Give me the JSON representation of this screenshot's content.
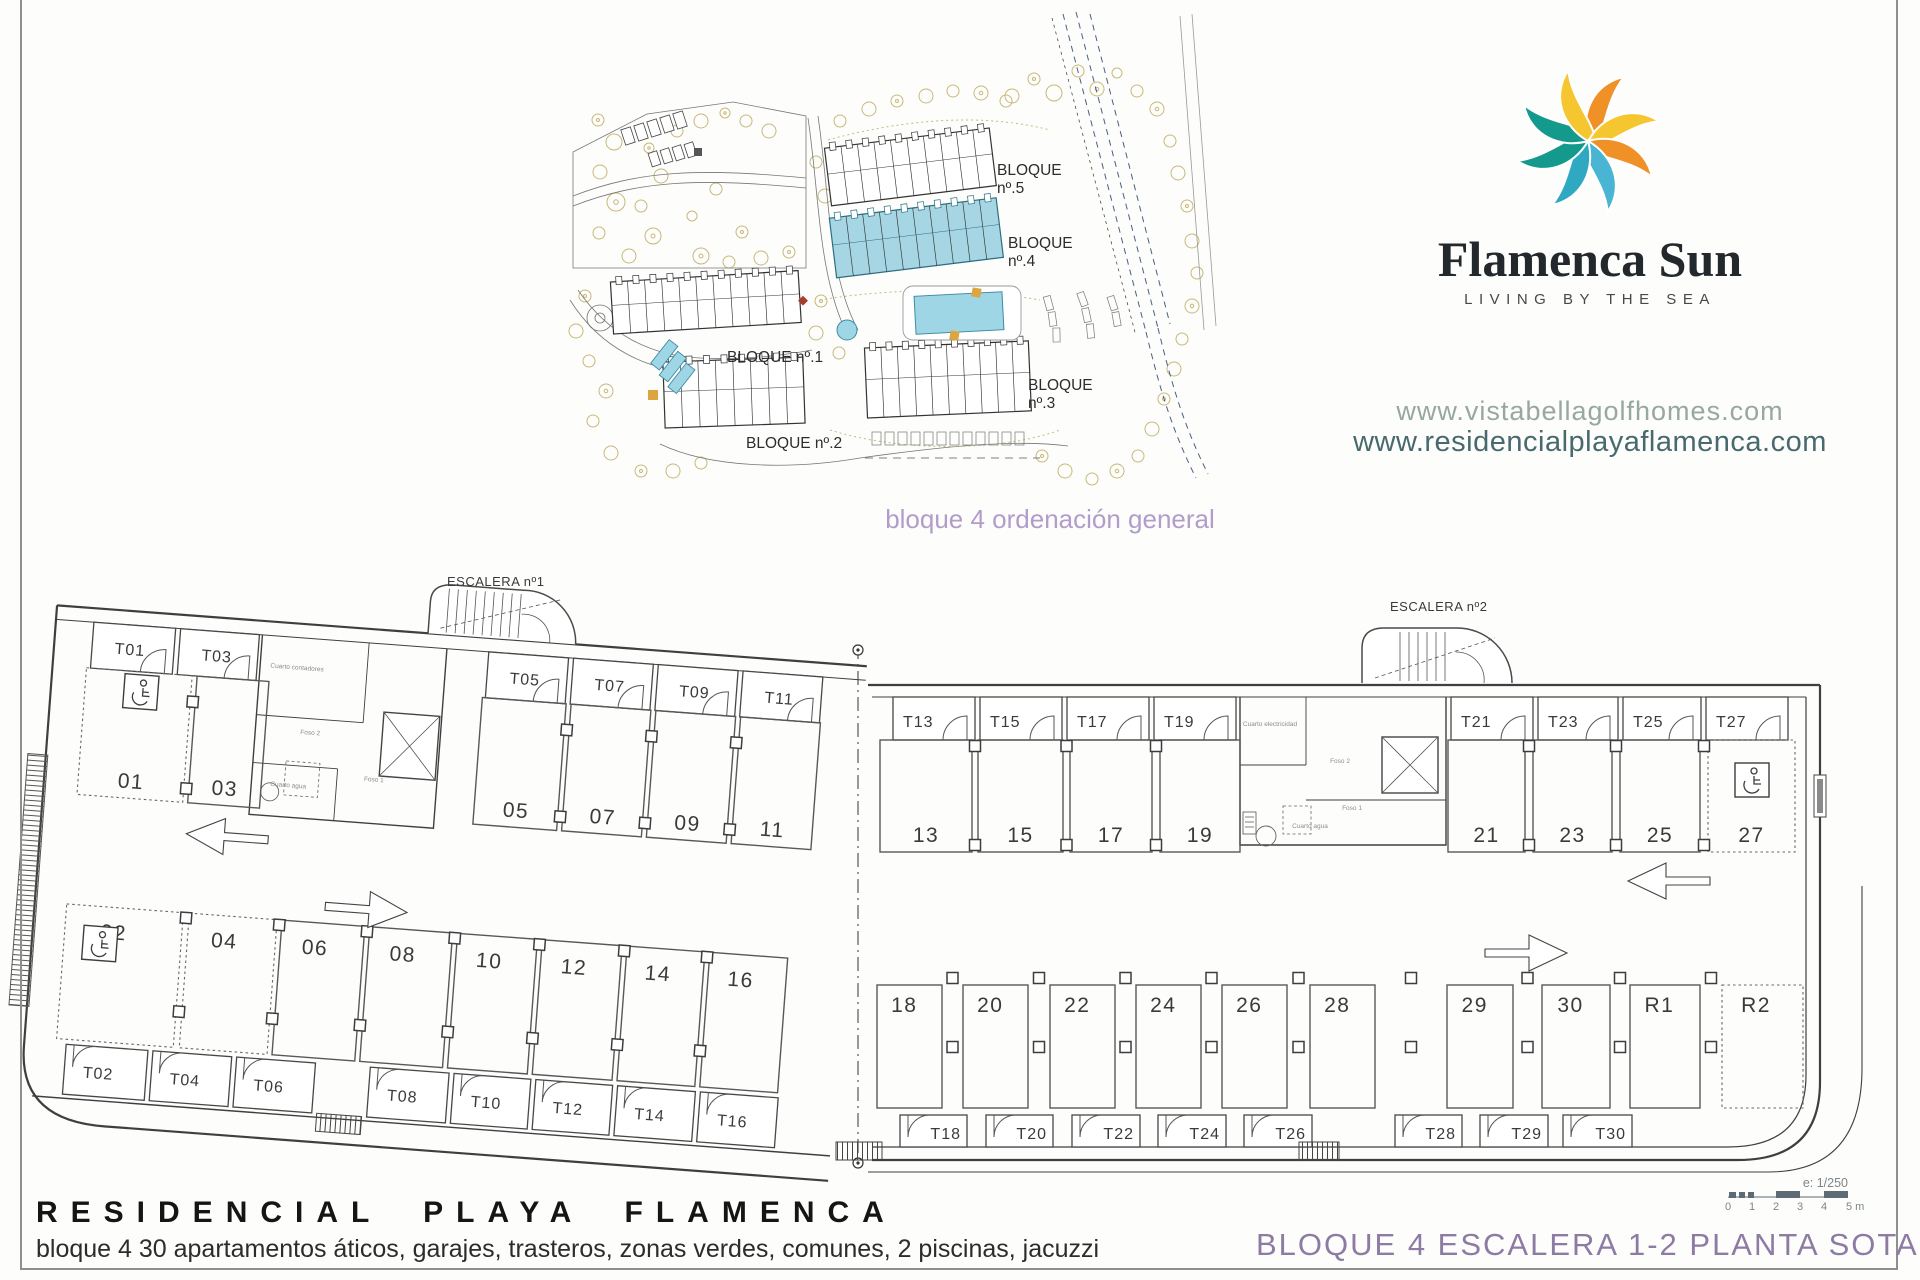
{
  "brand": {
    "name": "Flamenca Sun",
    "tagline": "LIVING BY THE SEA",
    "websites": {
      "primary": "www.vistabellagolfhomes.com",
      "secondary": "www.residencialplayaflamenca.com"
    },
    "logo_petal_colors": [
      "#ef9126",
      "#f5c62f",
      "#ef9126",
      "#49b5d2",
      "#2fa9c2",
      "#149a8c",
      "#149a8c",
      "#f5c62f"
    ]
  },
  "site_plan": {
    "caption": "bloque 4 ordenación general",
    "highlight_color": "#a6d6e3",
    "block_labels": [
      {
        "line1": "BLOQUE",
        "line2": "nº.5"
      },
      {
        "line1": "BLOQUE",
        "line2": "nº.4"
      },
      {
        "line1": "BLOQUE",
        "line2": "nº.3"
      },
      {
        "line1": "BLOQUE nº.1",
        "line2": ""
      },
      {
        "line1": "BLOQUE nº.2",
        "line2": ""
      }
    ]
  },
  "floor_plan": {
    "stairs": [
      "ESCALERA nº1",
      "ESCALERA nº2"
    ],
    "left_wing": {
      "top_storage": [
        "T01",
        "T03",
        "T05",
        "T07",
        "T09",
        "T11"
      ],
      "top_parking": [
        "01",
        "03",
        "05",
        "07",
        "09",
        "11"
      ],
      "bottom_parking": [
        "02",
        "04",
        "06",
        "08",
        "10",
        "12",
        "14",
        "16"
      ],
      "bottom_storage": [
        "T02",
        "T04",
        "T06",
        "T08",
        "T10",
        "T12",
        "T14",
        "T16"
      ]
    },
    "right_wing": {
      "top_storage": [
        "T13",
        "T15",
        "T17",
        "T19",
        "T21",
        "T23",
        "T25",
        "T27"
      ],
      "top_parking": [
        "13",
        "15",
        "17",
        "19",
        "21",
        "23",
        "25",
        "27"
      ],
      "bottom_parking": [
        "18",
        "20",
        "22",
        "24",
        "26",
        "28",
        "29",
        "30",
        "R1",
        "R2"
      ],
      "bottom_storage": [
        "T18",
        "T20",
        "T22",
        "T24",
        "T26",
        "T28",
        "T29",
        "T30"
      ]
    },
    "dotted_spaces": [
      "01",
      "02",
      "04",
      "27",
      "R2"
    ],
    "accessible_spaces": [
      "01",
      "02",
      "27"
    ],
    "technical_rooms_left": [
      "Cuarto contadores",
      "Foso 2",
      "Cuarto agua",
      "Foso 1"
    ],
    "technical_rooms_right": [
      "Cuarto electricidad",
      "Foso 2",
      "Cuarto agua",
      "Foso 1"
    ],
    "scale_bar": {
      "label": "e: 1/250",
      "ticks": [
        "0",
        "1",
        "2",
        "3",
        "4",
        "5 m"
      ]
    }
  },
  "footer": {
    "title": "RESIDENCIAL PLAYA FLAMENCA",
    "subtitle": "bloque 4 30 apartamentos áticos, garajes, trasteros, zonas verdes, comunes, 2 piscinas, jacuzzi",
    "plan_title": "BLOQUE 4 ESCALERA 1-2 PLANTA SOTANO"
  }
}
